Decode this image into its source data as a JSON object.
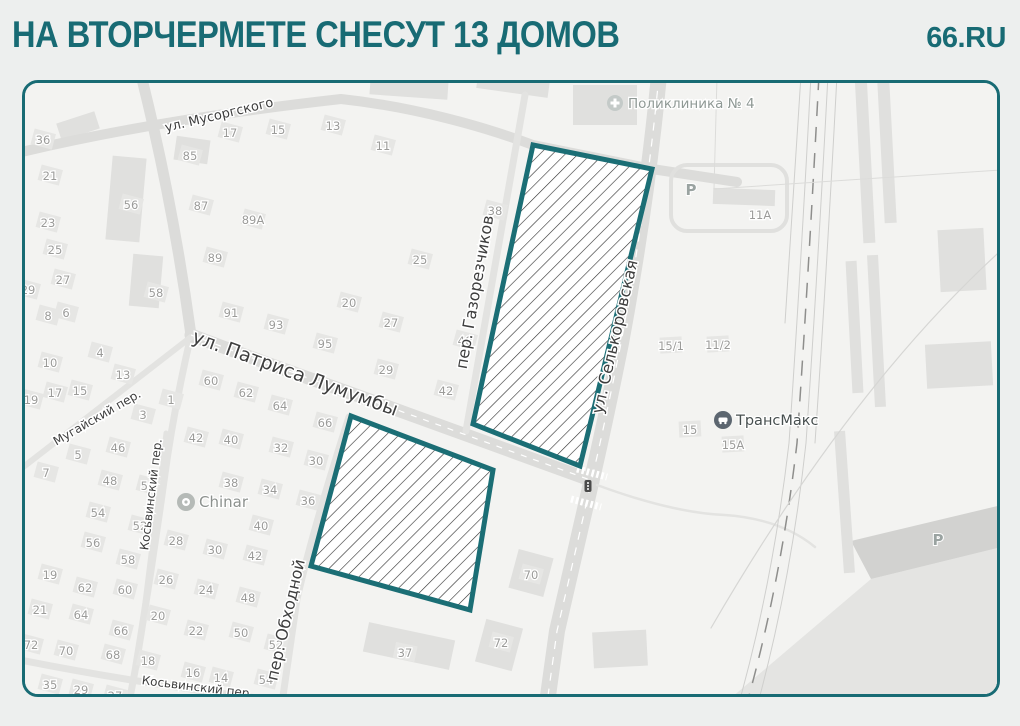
{
  "header": {
    "title": "НА ВТОРЧЕРМЕТЕ СНЕСУТ 13 ДОМОВ",
    "brand": "66.RU"
  },
  "colors": {
    "accent": "#186b74",
    "zone_stroke": "#1b6e75",
    "hatch_line": "#2d2d2d",
    "page_bg": "#edefee",
    "map_bg": "#f3f3f1",
    "road_major": "#dcdcda",
    "road_minor": "#e3e3e1",
    "building": "#e6e6e4",
    "shape": "#e0e0de",
    "number_text": "#9b9b99",
    "street_text": "#3e3e3e"
  },
  "map": {
    "zones": [
      {
        "name": "demolition-zone-north",
        "points": "508,62 627,86 555,383 448,341"
      },
      {
        "name": "demolition-zone-south",
        "points": "326,333 468,387 445,527 286,483"
      }
    ],
    "areas": [
      {
        "name": "parking-lot-area",
        "points": "700,620 846,496 985,462 985,620",
        "fill": "#e4e4e2"
      },
      {
        "name": "parking-lot-edge",
        "points": "826,458 985,420 985,462 846,496",
        "fill": "#d2d2d0"
      }
    ],
    "shapes": [
      {
        "x": 84,
        "y": 74,
        "w": 34,
        "h": 84,
        "r": 5
      },
      {
        "x": 106,
        "y": 172,
        "w": 30,
        "h": 52,
        "r": 5
      },
      {
        "x": 33,
        "y": 34,
        "w": 40,
        "h": 18,
        "r": -18
      },
      {
        "x": 150,
        "y": 55,
        "w": 34,
        "h": 24,
        "r": 8
      },
      {
        "x": 345,
        "y": -4,
        "w": 78,
        "h": 18,
        "r": 4
      },
      {
        "x": 452,
        "y": -6,
        "w": 72,
        "h": 16,
        "r": 8
      },
      {
        "x": 548,
        "y": 2,
        "w": 64,
        "h": 40,
        "r": 0
      },
      {
        "x": 688,
        "y": 106,
        "w": 62,
        "h": 16,
        "r": 2
      },
      {
        "x": 914,
        "y": 146,
        "w": 46,
        "h": 62,
        "r": -3
      },
      {
        "x": 901,
        "y": 260,
        "w": 66,
        "h": 44,
        "r": -3
      },
      {
        "x": 834,
        "y": -8,
        "w": 12,
        "h": 168,
        "r": -3
      },
      {
        "x": 856,
        "y": -2,
        "w": 12,
        "h": 142,
        "r": -3
      },
      {
        "x": 824,
        "y": 178,
        "w": 11,
        "h": 132,
        "r": -3
      },
      {
        "x": 846,
        "y": 172,
        "w": 11,
        "h": 152,
        "r": -3
      },
      {
        "x": 814,
        "y": 348,
        "w": 11,
        "h": 142,
        "r": -4
      },
      {
        "x": 568,
        "y": 548,
        "w": 54,
        "h": 36,
        "r": -3
      },
      {
        "x": 488,
        "y": 470,
        "w": 36,
        "h": 40,
        "r": 15
      },
      {
        "x": 455,
        "y": 540,
        "w": 38,
        "h": 44,
        "r": 15
      },
      {
        "x": 340,
        "y": 548,
        "w": 88,
        "h": 30,
        "r": 12
      }
    ],
    "roads": [
      {
        "name": "road-musorgskogo",
        "d": "M -24,74 Q 120,38 316,16 C 390,24 460,44 508,62 L 627,86 L 712,99",
        "w": 10
      },
      {
        "name": "road-main-north",
        "d": "M 116,-8 Q 148,120 166,252",
        "w": 11
      },
      {
        "name": "road-main-south",
        "d": "M 166,252 Q 148,330 139,398 Q 126,492 110,588 L 104,620",
        "w": 7,
        "c": "#e3e3e1"
      },
      {
        "name": "road-patrisa-lumumby",
        "d": "M 166,252 Q 240,280 320,308 L 568,398",
        "w": 13
      },
      {
        "name": "road-selkorovskaya",
        "d": "M 634,-8 Q 622,120 596,260 Q 580,340 566,400 Q 546,488 532,548 L 522,620",
        "w": 16
      },
      {
        "name": "road-gazorezchikov",
        "d": "M 500,12 L 441,348",
        "w": 7,
        "c": "#e3e3e1"
      },
      {
        "name": "road-obhodnoy",
        "d": "M 324,334 Q 288,446 272,516 L 257,620",
        "w": 7,
        "c": "#e3e3e1"
      },
      {
        "name": "road-kosvinsky-vertical",
        "d": "M 141,350 L 112,584",
        "w": 5,
        "c": "#e3e3e1"
      },
      {
        "name": "road-kosvinsky-bottom",
        "d": "M -10,576 Q 120,602 258,618 L 320,624",
        "w": 7,
        "c": "#e3e3e1"
      },
      {
        "name": "road-mugaysky",
        "d": "M -12,392 L 166,254",
        "w": 6,
        "c": "#e3e3e1"
      },
      {
        "name": "road-loop-11a",
        "d": "M 662,82 h 84 a16,16 0 0 1 16,16 v 34 a16,16 0 0 1 -16,16 h -84 a16,16 0 0 1 -16,-16 v -34 a16,16 0 0 1 16,-16 z",
        "w": 4,
        "c": "#e0e0de"
      },
      {
        "name": "path-east",
        "d": "M 572,402 Q 648,430 700,432 Q 756,436 790,464",
        "w": 2.5,
        "c": "#e3e3e1"
      },
      {
        "name": "lane-selkorovskaya",
        "d": "M 634,-8 Q 622,120 596,260 Q 580,340 566,400 Q 546,488 532,548 L 522,620",
        "w": 1.2,
        "c": "#ffffff",
        "dash": "8 8"
      },
      {
        "name": "lane-patrisa",
        "d": "M 166,252 Q 240,280 320,308 L 568,398",
        "w": 1.2,
        "c": "#ffffff",
        "dash": "6 7"
      },
      {
        "name": "crosswalk-north",
        "d": "M 552,386 L 582,394",
        "w": 7,
        "c": "#ffffff",
        "dash": "2.5 2.5"
      },
      {
        "name": "crosswalk-south",
        "d": "M 546,416 L 576,424",
        "w": 7,
        "c": "#ffffff",
        "dash": "2.5 2.5"
      },
      {
        "name": "railway-track-main",
        "d": "M 794,-8 Q 783,200 772,360 Q 756,498 722,620",
        "w": 1.5,
        "c": "#8e8e8c",
        "dash": "15 11"
      },
      {
        "name": "railway-track-side",
        "d": "M 786,-8 Q 775,200 764,360 Q 748,498 714,620",
        "w": 1,
        "c": "#cfcfcd"
      },
      {
        "name": "railway-track-side",
        "d": "M 803,-8 Q 792,200 781,360 Q 766,498 733,620",
        "w": 1,
        "c": "#cfcfcd"
      },
      {
        "name": "railway-track-side",
        "d": "M 812,-8 Q 801,200 790,360",
        "w": 1,
        "c": "#cfcfcd"
      },
      {
        "name": "railway-track-side",
        "d": "M 776,-8 Q 766,150 760,240",
        "w": 1,
        "c": "#cfcfcd"
      },
      {
        "name": "curved-path",
        "d": "M 982,162 Q 828,300 686,545",
        "w": 1.2,
        "c": "#d6d6d4"
      },
      {
        "name": "fence-line",
        "d": "M 692,-6 L 689,106 L 990,86",
        "w": 1,
        "c": "#dcdcda"
      }
    ],
    "houses": [
      {
        "n": "36",
        "x": 18,
        "y": 57
      },
      {
        "n": "21",
        "x": 25,
        "y": 93
      },
      {
        "n": "23",
        "x": 23,
        "y": 140
      },
      {
        "n": "25",
        "x": 30,
        "y": 167
      },
      {
        "n": "27",
        "x": 38,
        "y": 197
      },
      {
        "n": "29",
        "x": 3,
        "y": 207
      },
      {
        "n": "85",
        "x": 165,
        "y": 73
      },
      {
        "n": "87",
        "x": 176,
        "y": 123
      },
      {
        "n": "89А",
        "x": 228,
        "y": 137
      },
      {
        "n": "89",
        "x": 190,
        "y": 175
      },
      {
        "n": "17",
        "x": 205,
        "y": 50
      },
      {
        "n": "15",
        "x": 253,
        "y": 47
      },
      {
        "n": "13",
        "x": 308,
        "y": 43
      },
      {
        "n": "11",
        "x": 358,
        "y": 63
      },
      {
        "n": "38",
        "x": 470,
        "y": 128
      },
      {
        "n": "25",
        "x": 395,
        "y": 177
      },
      {
        "n": "56",
        "x": 106,
        "y": 122
      },
      {
        "n": "58",
        "x": 131,
        "y": 210
      },
      {
        "n": "8",
        "x": 23,
        "y": 233
      },
      {
        "n": "6",
        "x": 41,
        "y": 230
      },
      {
        "n": "10",
        "x": 25,
        "y": 280
      },
      {
        "n": "4",
        "x": 75,
        "y": 270
      },
      {
        "n": "13",
        "x": 98,
        "y": 292
      },
      {
        "n": "19",
        "x": 6,
        "y": 317
      },
      {
        "n": "17",
        "x": 30,
        "y": 310
      },
      {
        "n": "15",
        "x": 55,
        "y": 308
      },
      {
        "n": "3",
        "x": 118,
        "y": 332
      },
      {
        "n": "1",
        "x": 146,
        "y": 317
      },
      {
        "n": "5",
        "x": 53,
        "y": 372
      },
      {
        "n": "46",
        "x": 93,
        "y": 365
      },
      {
        "n": "7",
        "x": 21,
        "y": 390
      },
      {
        "n": "48",
        "x": 85,
        "y": 398
      },
      {
        "n": "50",
        "x": 123,
        "y": 403
      },
      {
        "n": "91",
        "x": 206,
        "y": 230
      },
      {
        "n": "93",
        "x": 251,
        "y": 242
      },
      {
        "n": "95",
        "x": 300,
        "y": 261
      },
      {
        "n": "60",
        "x": 186,
        "y": 298
      },
      {
        "n": "62",
        "x": 221,
        "y": 310
      },
      {
        "n": "64",
        "x": 255,
        "y": 323
      },
      {
        "n": "66",
        "x": 300,
        "y": 340
      },
      {
        "n": "42",
        "x": 171,
        "y": 355
      },
      {
        "n": "40",
        "x": 206,
        "y": 357
      },
      {
        "n": "32",
        "x": 256,
        "y": 365
      },
      {
        "n": "30",
        "x": 291,
        "y": 378
      },
      {
        "n": "38",
        "x": 206,
        "y": 400
      },
      {
        "n": "34",
        "x": 245,
        "y": 407
      },
      {
        "n": "36",
        "x": 283,
        "y": 418
      },
      {
        "n": "20",
        "x": 324,
        "y": 220
      },
      {
        "n": "27",
        "x": 366,
        "y": 240
      },
      {
        "n": "29",
        "x": 361,
        "y": 287
      },
      {
        "n": "40",
        "x": 440,
        "y": 258
      },
      {
        "n": "42",
        "x": 421,
        "y": 308
      },
      {
        "n": "54",
        "x": 73,
        "y": 430
      },
      {
        "n": "52",
        "x": 115,
        "y": 443
      },
      {
        "n": "56",
        "x": 68,
        "y": 460
      },
      {
        "n": "58",
        "x": 103,
        "y": 477
      },
      {
        "n": "28",
        "x": 151,
        "y": 458
      },
      {
        "n": "30",
        "x": 190,
        "y": 467
      },
      {
        "n": "40",
        "x": 236,
        "y": 443
      },
      {
        "n": "42",
        "x": 230,
        "y": 473
      },
      {
        "n": "19",
        "x": 25,
        "y": 492
      },
      {
        "n": "62",
        "x": 60,
        "y": 505
      },
      {
        "n": "60",
        "x": 100,
        "y": 507
      },
      {
        "n": "26",
        "x": 141,
        "y": 497
      },
      {
        "n": "24",
        "x": 181,
        "y": 507
      },
      {
        "n": "48",
        "x": 223,
        "y": 515
      },
      {
        "n": "21",
        "x": 15,
        "y": 527
      },
      {
        "n": "64",
        "x": 56,
        "y": 532
      },
      {
        "n": "20",
        "x": 133,
        "y": 533
      },
      {
        "n": "66",
        "x": 96,
        "y": 548
      },
      {
        "n": "22",
        "x": 171,
        "y": 548
      },
      {
        "n": "50",
        "x": 216,
        "y": 550
      },
      {
        "n": "52",
        "x": 251,
        "y": 562
      },
      {
        "n": "72",
        "x": 6,
        "y": 562
      },
      {
        "n": "70",
        "x": 41,
        "y": 568
      },
      {
        "n": "68",
        "x": 88,
        "y": 572
      },
      {
        "n": "18",
        "x": 123,
        "y": 578
      },
      {
        "n": "16",
        "x": 168,
        "y": 590
      },
      {
        "n": "14",
        "x": 196,
        "y": 595
      },
      {
        "n": "54",
        "x": 241,
        "y": 597
      },
      {
        "n": "35",
        "x": 25,
        "y": 602
      },
      {
        "n": "29",
        "x": 56,
        "y": 607
      },
      {
        "n": "27",
        "x": 90,
        "y": 613
      },
      {
        "n": "70",
        "x": 506,
        "y": 492,
        "r": 15
      },
      {
        "n": "72",
        "x": 476,
        "y": 560,
        "r": 15
      },
      {
        "n": "37",
        "x": 380,
        "y": 570,
        "r": 12
      },
      {
        "n": "11А",
        "x": 735,
        "y": 132,
        "r": 2,
        "flat": true
      },
      {
        "n": "15/1",
        "x": 646,
        "y": 263,
        "r": -3
      },
      {
        "n": "11/2",
        "x": 693,
        "y": 262,
        "r": -3
      },
      {
        "n": "15",
        "x": 665,
        "y": 347,
        "r": -3
      },
      {
        "n": "15А",
        "x": 708,
        "y": 362,
        "r": -3
      }
    ],
    "streets": [
      {
        "label": "ул. Мусоргского",
        "x": 195,
        "y": 36,
        "r": -13.5,
        "s": 13
      },
      {
        "label": "ул. Патриса Лумумбы",
        "x": 268,
        "y": 296,
        "r": 20,
        "s": 19
      },
      {
        "label": "Мугайский пер.",
        "x": 74,
        "y": 338,
        "r": -30,
        "s": 12
      },
      {
        "label": "Косьвинский пер.",
        "x": 130,
        "y": 412,
        "r": -83,
        "s": 12
      },
      {
        "label": "Косьвинский пер.",
        "x": 172,
        "y": 608,
        "r": 7,
        "s": 12
      },
      {
        "label": "пер. Обходной",
        "x": 266,
        "y": 538,
        "r": -77,
        "s": 16
      },
      {
        "label": "пер. Газорезчиков",
        "x": 455,
        "y": 210,
        "r": -80,
        "s": 16
      },
      {
        "label": "ул. Селькоровская",
        "x": 595,
        "y": 255,
        "r": -77,
        "s": 16
      }
    ],
    "pois": [
      {
        "label": "Поликлиника № 4",
        "icon": "medical-cross-icon",
        "x": 590,
        "y": 20,
        "color": "#8f9995",
        "size": 13.5
      },
      {
        "label": "ТрансМакс",
        "icon": "car-icon",
        "x": 698,
        "y": 337,
        "color": "#474f4f",
        "size": 14.5
      },
      {
        "label": "Chinar",
        "icon": "restaurant-icon",
        "x": 161,
        "y": 419,
        "color": "#8c918e",
        "size": 15
      }
    ],
    "parking_labels": [
      {
        "label": "Р",
        "x": 666,
        "y": 107
      },
      {
        "label": "Р",
        "x": 913,
        "y": 457
      }
    ],
    "traffic_light": {
      "x": 563,
      "y": 403
    }
  }
}
